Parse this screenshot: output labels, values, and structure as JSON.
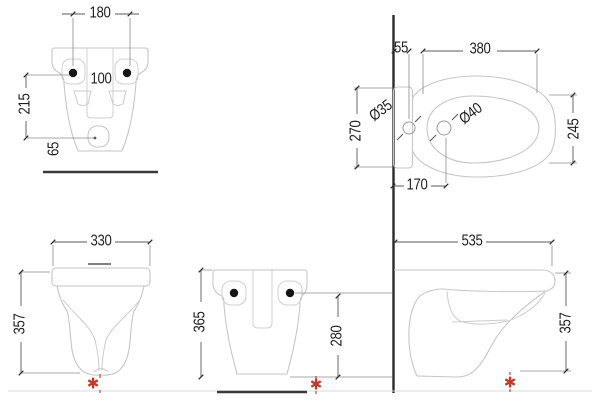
{
  "drawing": {
    "type": "technical-drawing",
    "subject": "wall-hung bidet installation dimensions",
    "units": "mm",
    "colors": {
      "fixture_outline": "#c6c6c6",
      "dimension_line": "#5a5a5a",
      "text": "#1f1f1f",
      "wall_line": "#2b2b2b",
      "accent_red": "#c0392b",
      "floor_line": "#d9d9d9"
    },
    "views": {
      "rear_mounting": {
        "dims": {
          "holes_width": "180",
          "inlet_spacing": "100",
          "holes_height": "215",
          "drain_offset": "65"
        }
      },
      "top": {
        "dims": {
          "wall_offset": "55",
          "bowl_length": "380",
          "faucet_hole_diameter": "Ø35",
          "tap_hole_diameter": "Ø40",
          "back_width": "270",
          "bowl_width": "245",
          "tap_distance": "170"
        }
      },
      "front": {
        "dims": {
          "width": "330",
          "height": "357"
        }
      },
      "rear": {
        "dims": {
          "height": "365",
          "holes_height": "280"
        }
      },
      "side": {
        "dims": {
          "depth": "535",
          "height": "357"
        }
      }
    },
    "marks": {
      "asterisk": "✱"
    }
  }
}
